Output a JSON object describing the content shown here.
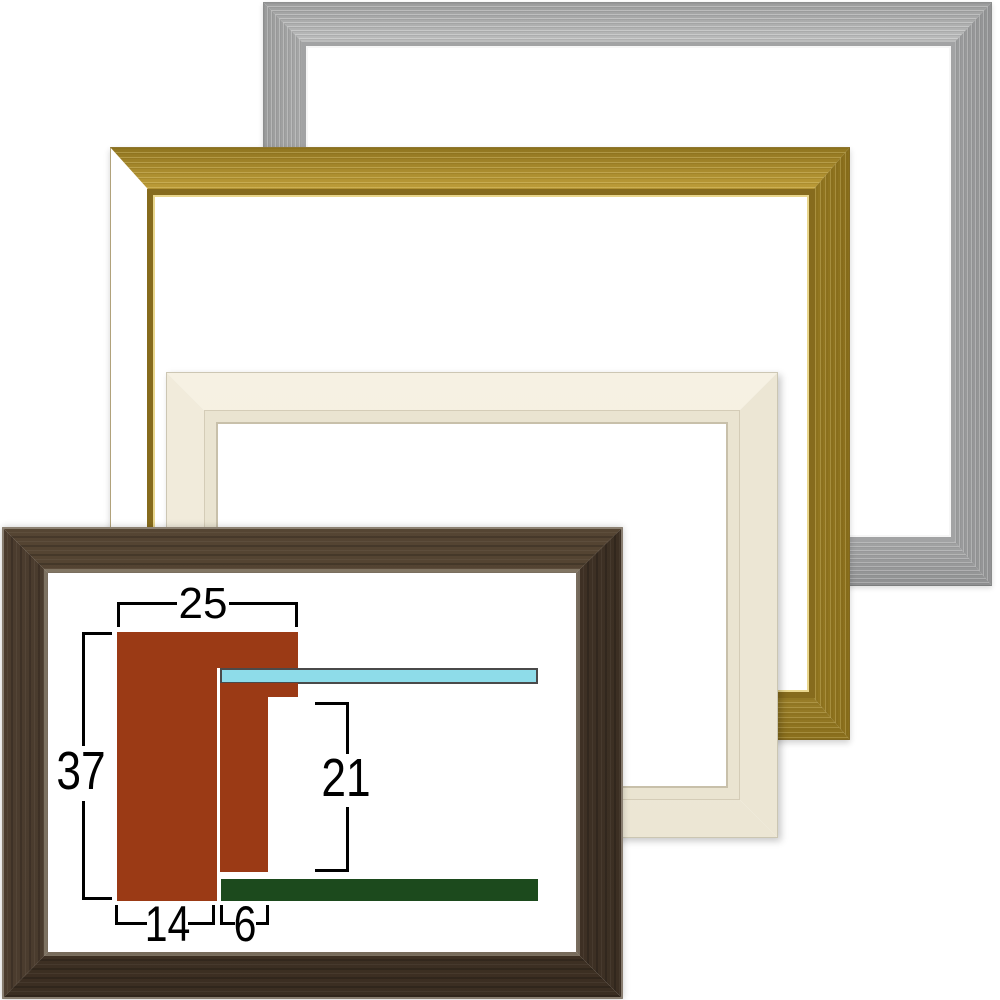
{
  "colors": {
    "moulding": "#9b3a15",
    "glass": "#8edce9",
    "glass_edge": "#4a4a4a",
    "backboard": "#1c4a1d",
    "dimension_line": "#000000",
    "frame_silver": "#c9caca",
    "frame_gold": "#c7a63e",
    "frame_cream": "#f2eddd",
    "frame_brown": "#48392b"
  },
  "diagram": {
    "labels": {
      "overall_width": "25",
      "overall_height": "37",
      "inner_height": "21",
      "face_width": "14",
      "lip_width": "6"
    }
  }
}
